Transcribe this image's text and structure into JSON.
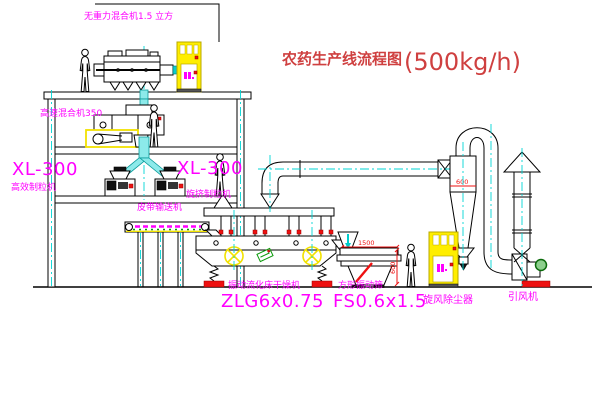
{
  "title": {
    "text": "农药生产线流程图",
    "capacity": "(500kg/h)"
  },
  "labels": {
    "gravity_free_mixer": "无重力混合机1.5 立方",
    "high_speed_mixer": "高速混合机350",
    "granulator_left_model": "XL-300",
    "granulator_left_name": "高效制粒机",
    "granulator_mid_model": "XL-300",
    "granulator_mid_name": "旋挤制粒机",
    "belt_conveyor": "皮带输送机",
    "dryer_name": "振动流化床干燥机",
    "dryer_model": "ZLG6x0.75",
    "sieve_name": "方形振动筛",
    "sieve_model": "FS0.6x1.5",
    "cyclone_name": "旋风除尘器",
    "fan_name": "引风机"
  },
  "dimensions": {
    "sieve_length": "1500",
    "sieve_width": "600",
    "cyclone_diameter": "600"
  },
  "colors": {
    "label_magenta": "#ff00ff",
    "title_red": "#cf4040",
    "line_black": "#000000",
    "centerline_cyan": "#00d5d5",
    "equipment_yellow": "#f2e200",
    "dimension_red": "#ee1111",
    "motor_green": "#008800"
  }
}
